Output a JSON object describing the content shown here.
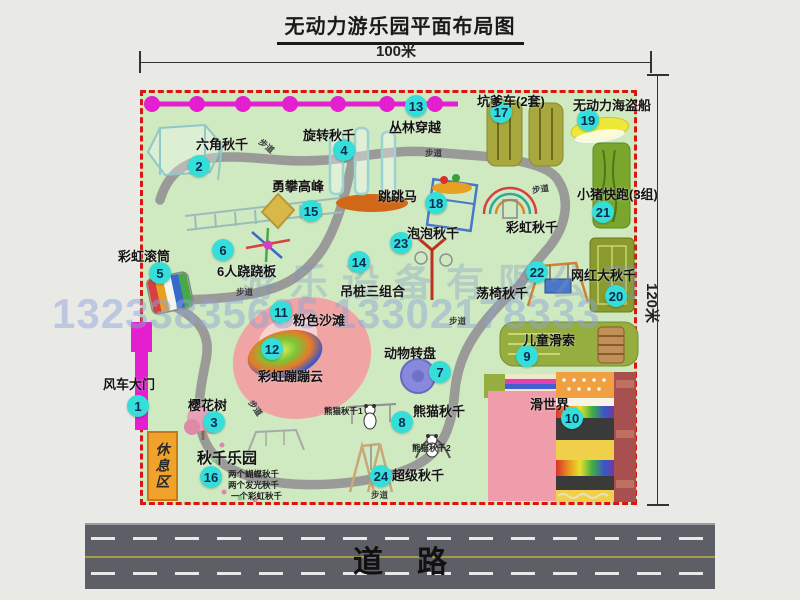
{
  "title": "无动力游乐园平面布局图",
  "dimensions": {
    "top": "100米",
    "right": "120米"
  },
  "road": {
    "label": "道路"
  },
  "watermark": {
    "company": "游乐设备有限公司",
    "phone": "13233835635 13302178333"
  },
  "rest_area": {
    "label": "休息区"
  },
  "path_label": "步道",
  "colors": {
    "park_green": "#cfe9c0",
    "border_red": "#dd1414",
    "marker_cyan": "#34dfd9",
    "gate_magenta": "#e41fd0",
    "road_gray": "#5e5e66",
    "rest_orange": "#f0a22a"
  },
  "markers": [
    {
      "num": "1",
      "label": "风车大门",
      "cx": 138,
      "cy": 406,
      "lx": 103,
      "ly": 374
    },
    {
      "num": "2",
      "label": "六角秋千",
      "cx": 199,
      "cy": 166,
      "lx": 196,
      "ly": 134
    },
    {
      "num": "3",
      "label": "樱花树",
      "cx": 214,
      "cy": 422,
      "lx": 188,
      "ly": 395
    },
    {
      "num": "4",
      "label": "旋转秋千",
      "cx": 344,
      "cy": 150,
      "lx": 303,
      "ly": 125
    },
    {
      "num": "5",
      "label": "彩虹滚筒",
      "cx": 160,
      "cy": 273,
      "lx": 118,
      "ly": 246
    },
    {
      "num": "6",
      "label": "6人跷跷板",
      "cx": 223,
      "cy": 250,
      "lx": 217,
      "ly": 261
    },
    {
      "num": "7",
      "label": "动物转盘",
      "cx": 440,
      "cy": 372,
      "lx": 384,
      "ly": 343
    },
    {
      "num": "8",
      "label": "熊猫秋千",
      "cx": 402,
      "cy": 422,
      "lx": 413,
      "ly": 401
    },
    {
      "num": "9",
      "label": "儿童滑索",
      "cx": 527,
      "cy": 356,
      "lx": 523,
      "ly": 330
    },
    {
      "num": "10",
      "label": "滑世界",
      "cx": 572,
      "cy": 418,
      "lx": 530,
      "ly": 394
    },
    {
      "num": "11",
      "label": "粉色沙滩",
      "cx": 281,
      "cy": 312,
      "lx": 293,
      "ly": 310
    },
    {
      "num": "12",
      "label": "彩虹蹦蹦云",
      "cx": 272,
      "cy": 349,
      "lx": 258,
      "ly": 366
    },
    {
      "num": "13",
      "label": "丛林穿越",
      "cx": 416,
      "cy": 106,
      "lx": 389,
      "ly": 117
    },
    {
      "num": "14",
      "label": "吊桩三组合",
      "cx": 359,
      "cy": 262,
      "lx": 340,
      "ly": 281
    },
    {
      "num": "15",
      "label": "勇攀高峰",
      "cx": 311,
      "cy": 211,
      "lx": 272,
      "ly": 176
    },
    {
      "num": "16",
      "label": "秋千乐园",
      "cx": 211,
      "cy": 477,
      "lx": 197,
      "ly": 447,
      "lfs": 15
    },
    {
      "num": "17",
      "label": "坑爹车(2套)",
      "cx": 501,
      "cy": 112,
      "lx": 477,
      "ly": 91
    },
    {
      "num": "18",
      "label": "跳跳马",
      "cx": 436,
      "cy": 203,
      "lx": 378,
      "ly": 186
    },
    {
      "num": "19",
      "label": "无动力海盗船",
      "cx": 588,
      "cy": 120,
      "lx": 573,
      "ly": 95
    },
    {
      "num": "20",
      "label": "网红大秋千",
      "cx": 616,
      "cy": 296,
      "lx": 571,
      "ly": 265
    },
    {
      "num": "21",
      "label": "小猪快跑(3组)",
      "cx": 603,
      "cy": 212,
      "lx": 577,
      "ly": 184
    },
    {
      "num": "22",
      "label": "荡椅秋千",
      "cx": 537,
      "cy": 272,
      "lx": 476,
      "ly": 283
    },
    {
      "num": "23",
      "label": "泡泡秋千",
      "cx": 401,
      "cy": 243,
      "lx": 407,
      "ly": 223
    },
    {
      "num": "24",
      "label": "超级秋千",
      "cx": 381,
      "cy": 476,
      "lx": 392,
      "ly": 465
    }
  ],
  "extra_labels": [
    {
      "text": "彩虹秋千",
      "x": 506,
      "y": 217,
      "fs": 13
    },
    {
      "text": "熊猫秋千1",
      "x": 324,
      "y": 405,
      "fs": 8.5
    },
    {
      "text": "熊猫秋千2",
      "x": 412,
      "y": 442,
      "fs": 8.5
    },
    {
      "text": "两个蝴蝶秋千",
      "x": 228,
      "y": 468,
      "fs": 8.5
    },
    {
      "text": "两个发光秋千",
      "x": 228,
      "y": 479,
      "fs": 8.5
    },
    {
      "text": "一个彩虹秋千",
      "x": 231,
      "y": 490,
      "fs": 8.5
    }
  ],
  "path_label_positions": [
    {
      "x": 258,
      "y": 140,
      "r": 40
    },
    {
      "x": 425,
      "y": 147,
      "r": 0
    },
    {
      "x": 532,
      "y": 183,
      "r": -8
    },
    {
      "x": 236,
      "y": 286,
      "r": 0
    },
    {
      "x": 449,
      "y": 315,
      "r": 0
    },
    {
      "x": 247,
      "y": 402,
      "r": 55
    },
    {
      "x": 371,
      "y": 489,
      "r": 0
    }
  ]
}
